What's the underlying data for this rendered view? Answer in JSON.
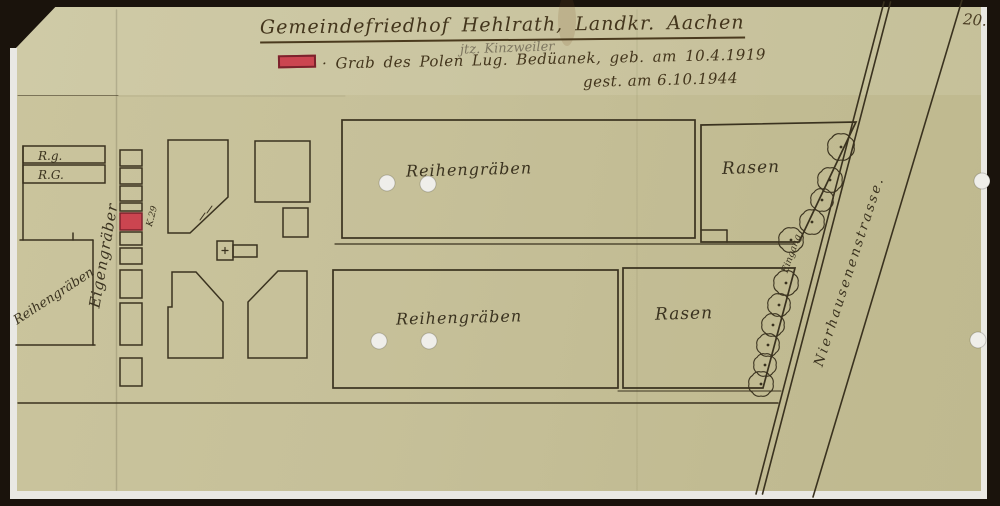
{
  "header": {
    "title": "Gemeindefriedhof Hehlrath, Landkr. Aachen",
    "pencil_note": "jtz. Kinzweiler",
    "page_number": "20.",
    "legend": {
      "line1": "· Grab des Polen Lug. Bedüanek, geb. am 10.4.1919",
      "line2": "gest. am 6.10.1944",
      "symbol": "red-grave-marker",
      "symbol_color": "#cb4550"
    }
  },
  "map": {
    "areas": {
      "rg_strip_1": "R.g.",
      "rg_strip_2": "R.G.",
      "eigengraeber": "Eigengräber",
      "reihengraeben_left": "Reihengräben",
      "reihengraeben_top": "Reihengräben",
      "reihengraeben_bottom": "Reihengräben",
      "rasen_top": "Rasen",
      "rasen_bottom": "Rasen"
    },
    "grave_label": "K.29",
    "entrance_label": "Eingang",
    "street_label": "Nierhausenenstrasse.",
    "colors": {
      "paper": "#c6c099",
      "ink": "#3a321f",
      "grave_red": "#cb4550",
      "pencil_gray": "#7d7660"
    }
  }
}
